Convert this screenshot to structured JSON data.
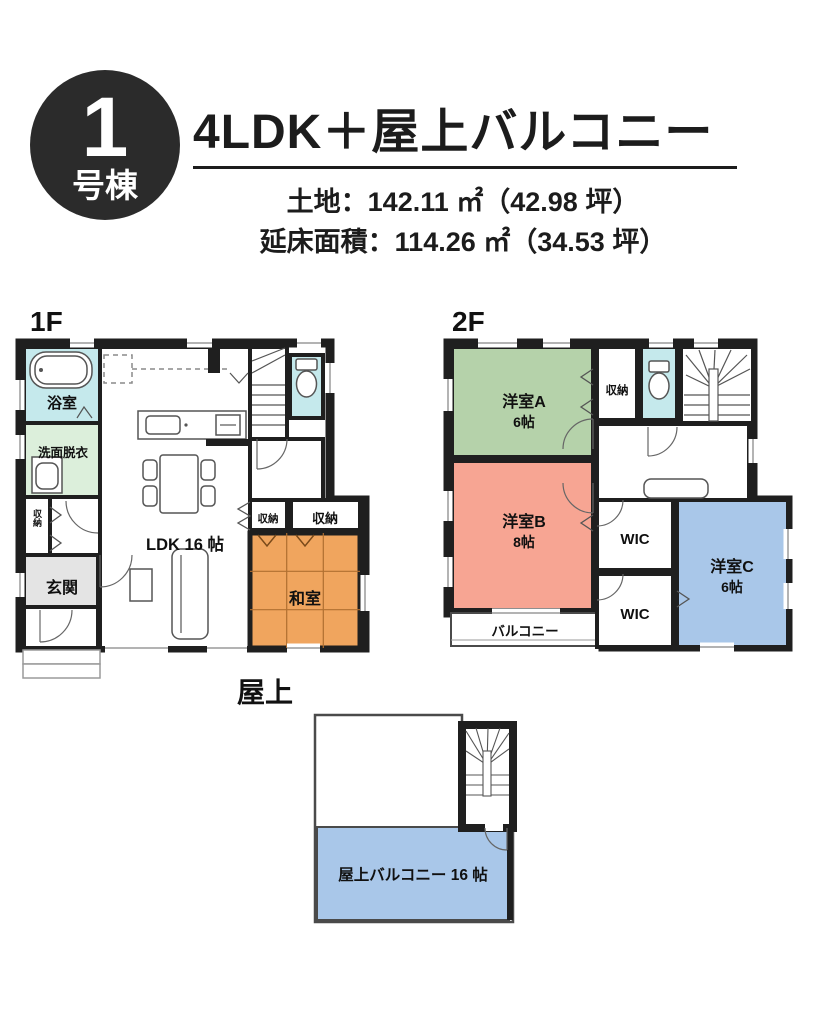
{
  "header": {
    "badge": {
      "number": "1",
      "label": "号棟"
    },
    "title": "4LDK＋屋上バルコニー",
    "land": "土地：142.11 ㎡（42.98 坪）",
    "floor_area": "延床面積：114.26 ㎡（34.53 坪）"
  },
  "floors": {
    "f1": {
      "heading": "1F",
      "rooms": {
        "bath": "浴室",
        "washroom": "洗面脱衣",
        "hall_closet": "収納",
        "entrance": "玄関",
        "ldk": "LDK 16 帖",
        "closet_a": "収納",
        "closet_b": "収納",
        "tatami": "和室"
      }
    },
    "f2": {
      "heading": "2F",
      "rooms": {
        "room_a": "洋室A",
        "room_a_size": "6帖",
        "closet": "収納",
        "room_b": "洋室B",
        "room_b_size": "8帖",
        "wic_upper": "WIC",
        "wic_lower": "WIC",
        "room_c": "洋室C",
        "room_c_size": "6帖",
        "balcony": "バルコニー"
      }
    },
    "roof": {
      "heading": "屋上",
      "balcony": "屋上バルコニー 16 帖"
    }
  },
  "colors": {
    "wall": "#1f1f1f",
    "badge_bg": "#2b2b2b",
    "bath": "#c5e9ec",
    "toilet": "#c5e9ec",
    "washroom": "#dcefdb",
    "entrance": "#e4e4e4",
    "tatami": "#f0a55e",
    "room_a_green": "#b5d2aa",
    "room_b_salmon": "#f7a593",
    "room_c_blue": "#a9c7e9",
    "roof_balcony_blue": "#a9c7e9",
    "white_room": "#ffffff"
  }
}
